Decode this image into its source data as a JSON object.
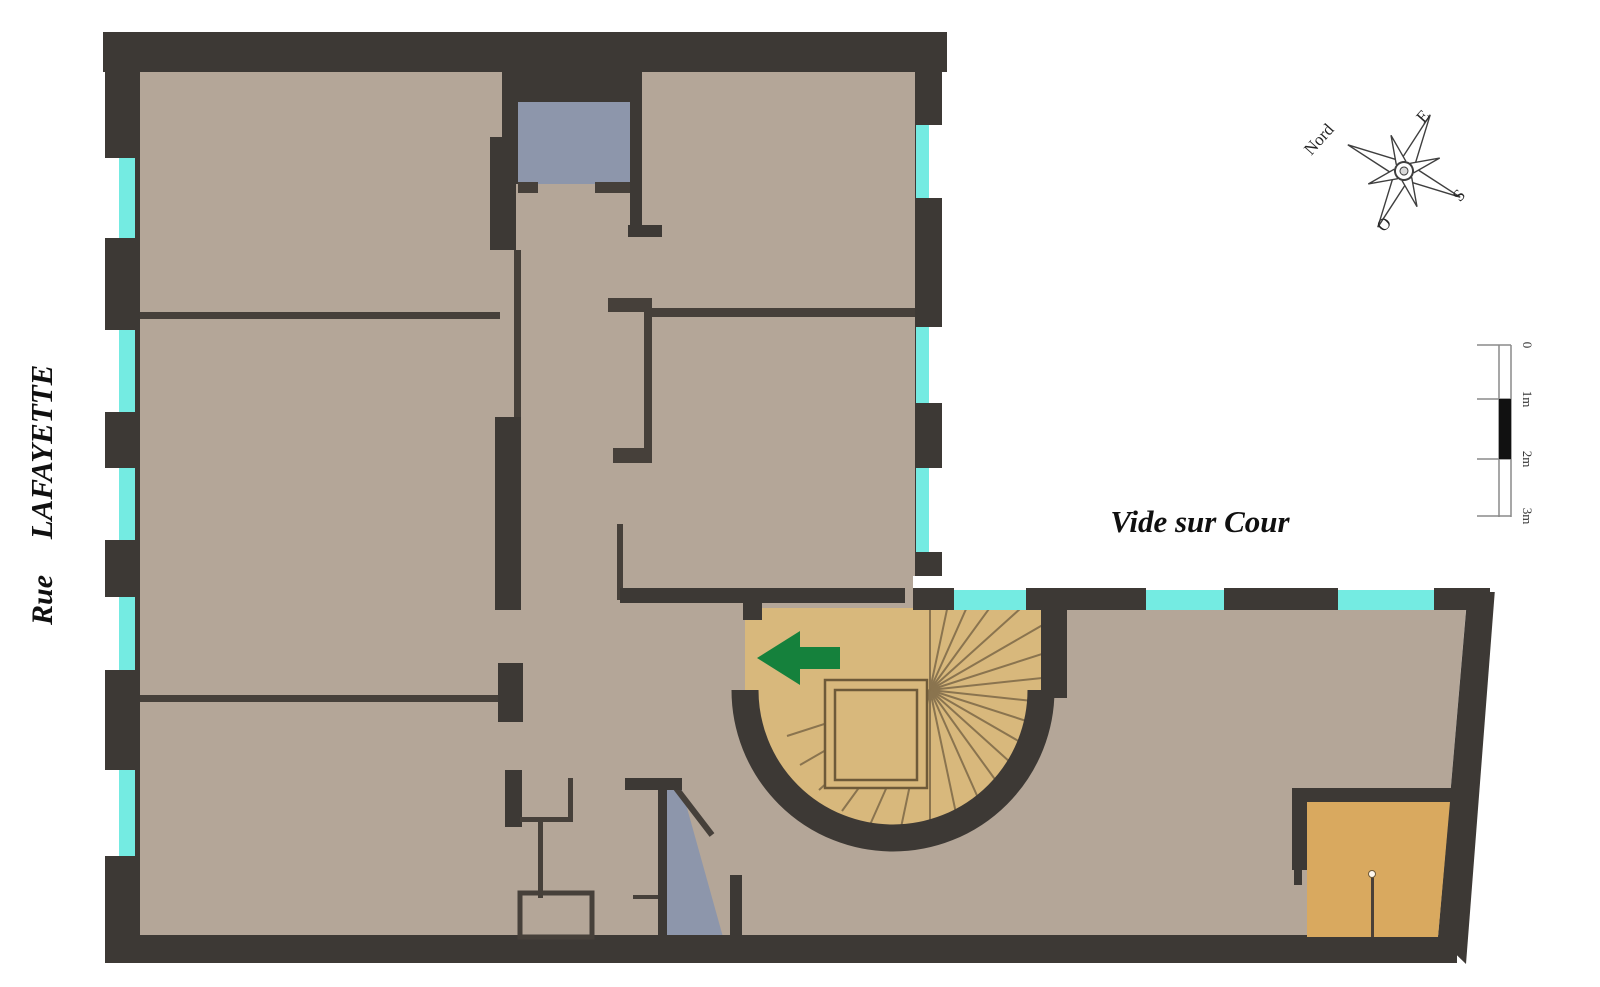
{
  "street": {
    "word1": "Rue",
    "word2": "LAFAYETTE"
  },
  "courtyard_label": "Vide sur Cour",
  "compass": {
    "north": "Nord",
    "east": "E",
    "south": "S",
    "west": "O"
  },
  "scale_bar": {
    "ticks": [
      "0",
      "1m",
      "2m",
      "3m"
    ]
  },
  "palette": {
    "wall": "#3d3935",
    "floor": "#b4a698",
    "stair_wood": "#d8b87c",
    "alcove_wood": "#d9a95f",
    "closet_blue": "#8d96ab",
    "window_glass": "#74ebe2",
    "window_frame": "#ffffff",
    "arrow_green": "#15813c",
    "background": "#ffffff"
  }
}
